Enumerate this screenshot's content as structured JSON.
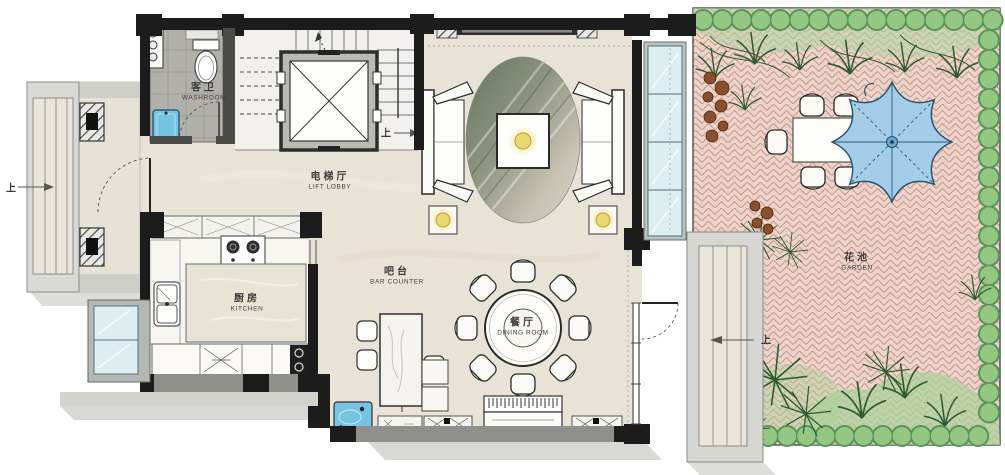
{
  "rooms": {
    "washroom": {
      "zh": "客卫",
      "en": "WASHROOM"
    },
    "lift_lobby": {
      "zh": "电梯厅",
      "en": "LIFT LOBBY"
    },
    "kitchen": {
      "zh": "厨房",
      "en": "KITCHEN"
    },
    "bar_counter": {
      "zh": "吧台",
      "en": "BAR COUNTER"
    },
    "dining_room": {
      "zh": "餐厅",
      "en": "DINING ROOM"
    },
    "garden": {
      "zh": "花池",
      "en": "GARDEN"
    }
  },
  "markers": {
    "up_entry": "上",
    "up_stairs": "上",
    "up_garden": "上"
  },
  "colors": {
    "wall": "#1c1c1c",
    "floor_marble": "#e9e3d7",
    "kitchen_floor": "#f7f6f1",
    "washroom_tile": "#b2b0ab",
    "stair_floor": "#f1f0ed",
    "garden_paving": "#eed3c9",
    "paving_joint": "#c49a90",
    "hedge": "#93c884",
    "hedge_outline": "#5a9458",
    "foliage": "#2f5c33",
    "planter_brown": "#8a4f2e",
    "umbrella": "#a3cde8",
    "umbrella_rib": "#2b5d78",
    "glass": "#ddeef0",
    "water": "#74c4e2",
    "lamp": "#ead96e",
    "rug_dark": "#6d7a6c",
    "label_text": "#3d3d3c"
  }
}
